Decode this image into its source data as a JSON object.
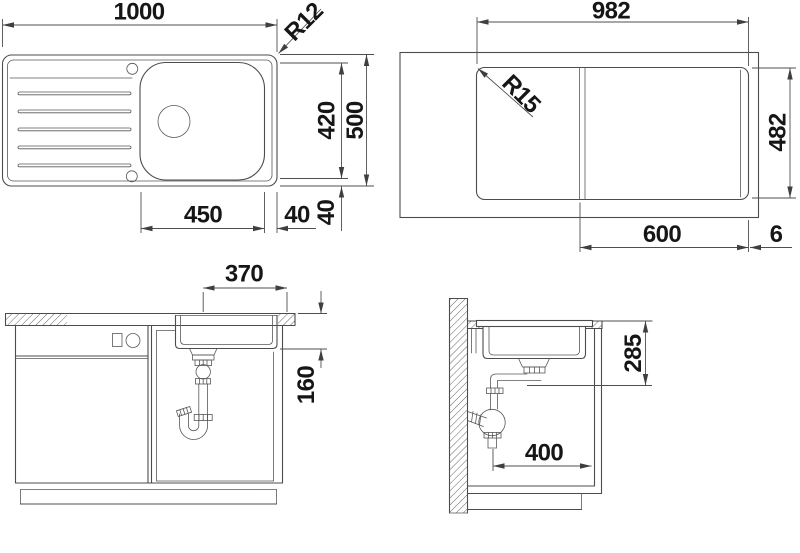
{
  "colors": {
    "background": "#ffffff",
    "line": "#4c4c4c",
    "text": "#161616"
  },
  "views": {
    "sink_plan": {
      "name": "Sink top view",
      "dims": {
        "overall_width": "1000",
        "corner_radius": "R12",
        "bowl_depth": "420",
        "overall_depth": "500",
        "bowl_width": "450",
        "bowl_side_gap": "40",
        "bowl_back_gap": "40"
      }
    },
    "cutout_plan": {
      "name": "Worktop cutout top view",
      "dims": {
        "cutout_width": "982",
        "corner_radius": "R15",
        "cutout_depth": "482",
        "bowl_zone_width": "600",
        "edge_offset": "6"
      }
    },
    "front_section": {
      "name": "Front section through cabinet",
      "dims": {
        "drain_to_edge": "370",
        "bowl_inner_depth": "160"
      }
    },
    "side_section": {
      "name": "Side section at wall",
      "dims": {
        "outlet_height": "285",
        "trap_clearance": "400"
      }
    }
  }
}
